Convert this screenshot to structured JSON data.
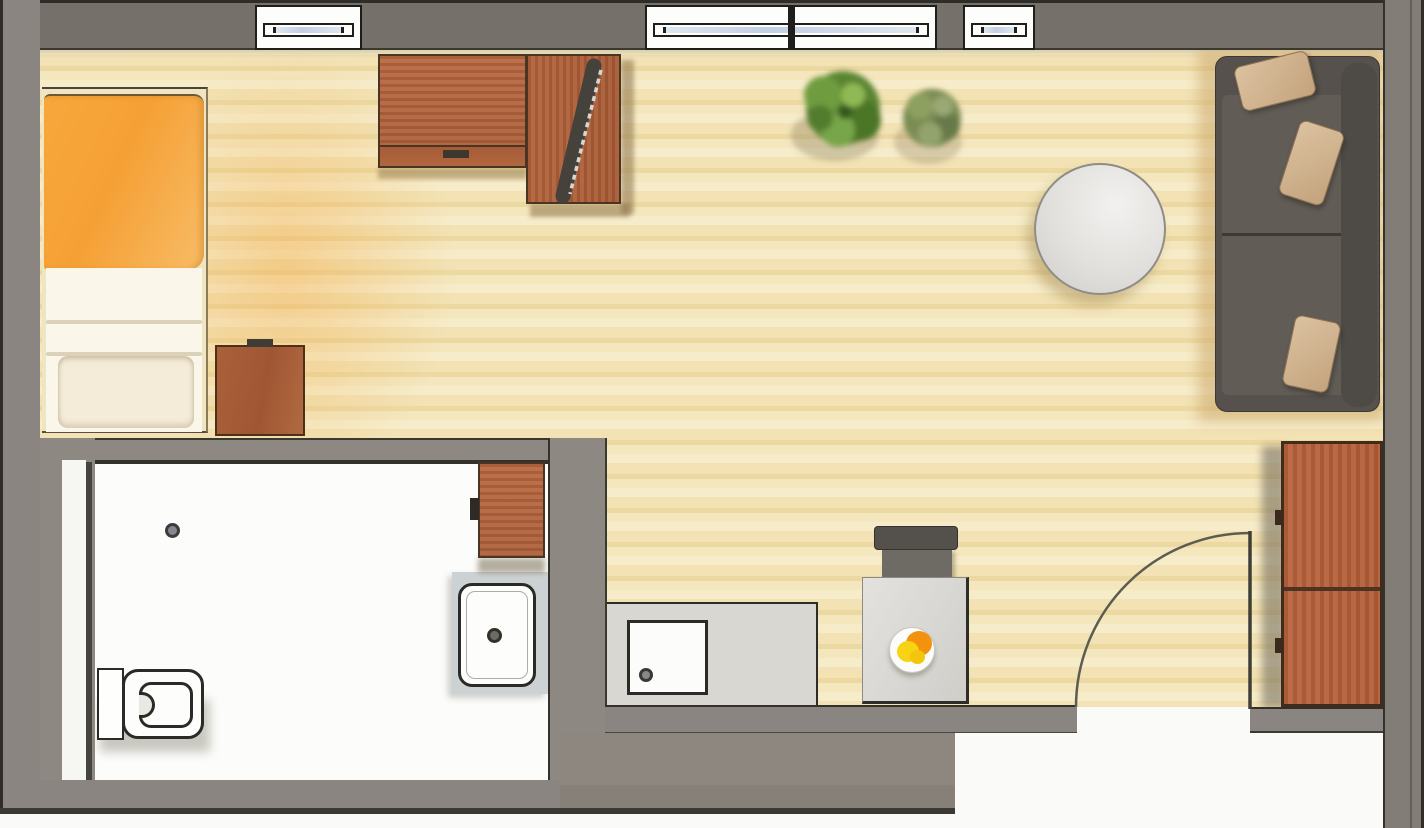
{
  "meta": {
    "type": "floor-plan",
    "description": "Scanned color floor plan (top view) of a single-room apartment with bathroom, kitchenette, sleeping area and living area",
    "canvas_width_px": 1424,
    "canvas_height_px": 828,
    "visible_text": "none"
  },
  "colors": {
    "outside": "#fafaf8",
    "wall_top": "#75716a",
    "wall": "#8a8580",
    "wall_partition": "#8d8882",
    "wall_outline": "#2f2d28",
    "floor_wood": "#f2e2b4",
    "bathroom_floor": "#fcfcfa",
    "glass_blue": "#c2d0e4",
    "wood_furniture": "#ad613b",
    "bed_blanket_orange": "#f5a035",
    "bed_sheet": "#fbf6ea",
    "sofa_body": "#56514c",
    "sofa_seat": "#615c56",
    "pillow_beige": "#d0b28e",
    "plant_green": "#5a8531",
    "plant_sage": "#7b8c52",
    "counter_gray": "#d9d7d2",
    "table_gray": "#d7d6d2",
    "fixture_white": "#fdfdfb",
    "food_orange": "#f2920e",
    "food_yellow": "#f8d313"
  },
  "rooms": [
    {
      "id": "main-room",
      "label": "combined sleeping / living room with wood floor"
    },
    {
      "id": "bathroom",
      "label": "bathroom with white floor, lower left"
    },
    {
      "id": "kitchenette",
      "label": "kitchen corner along bottom wall"
    }
  ],
  "windows": {
    "openings": 3,
    "panes": 4,
    "style": "white frame with central blue glazing band",
    "location": "top exterior wall"
  },
  "door": {
    "type": "hinged swing door with quarter-circle arc",
    "location": "bottom-right exterior wall"
  },
  "bath_door": {
    "type": "panel door shown against left bathroom wall",
    "location": "bathroom left side"
  },
  "furniture": [
    {
      "id": "bed",
      "label": "single bed with orange duvet and white sheets/pillow"
    },
    {
      "id": "nightstand",
      "label": "wooden bedside cabinet"
    },
    {
      "id": "desk",
      "label": "L-shaped wooden desk"
    },
    {
      "id": "monitor",
      "label": "computer monitor on desk, placed diagonally"
    },
    {
      "id": "plant-large",
      "label": "large green potted plant"
    },
    {
      "id": "plant-small",
      "label": "smaller sage-green potted plant"
    },
    {
      "id": "sofa",
      "label": "dark gray sofa with three beige cushions"
    },
    {
      "id": "round-table",
      "label": "round white coffee table"
    },
    {
      "id": "wardrobe",
      "label": "two-door wooden wardrobe beside entrance"
    },
    {
      "id": "dining-table",
      "label": "small square table with plate of food"
    },
    {
      "id": "chair",
      "label": "dark chair at the small table"
    },
    {
      "id": "kitchen-counter",
      "label": "kitchen counter with white sink/cooktop unit"
    },
    {
      "id": "bath-cabinet",
      "label": "wooden bathroom cabinet"
    },
    {
      "id": "washbasin",
      "label": "washbasin on gray vanity counter"
    },
    {
      "id": "toilet",
      "label": "toilet with cistern against left wall"
    },
    {
      "id": "floor-drain",
      "label": "round floor drain in shower area"
    }
  ]
}
